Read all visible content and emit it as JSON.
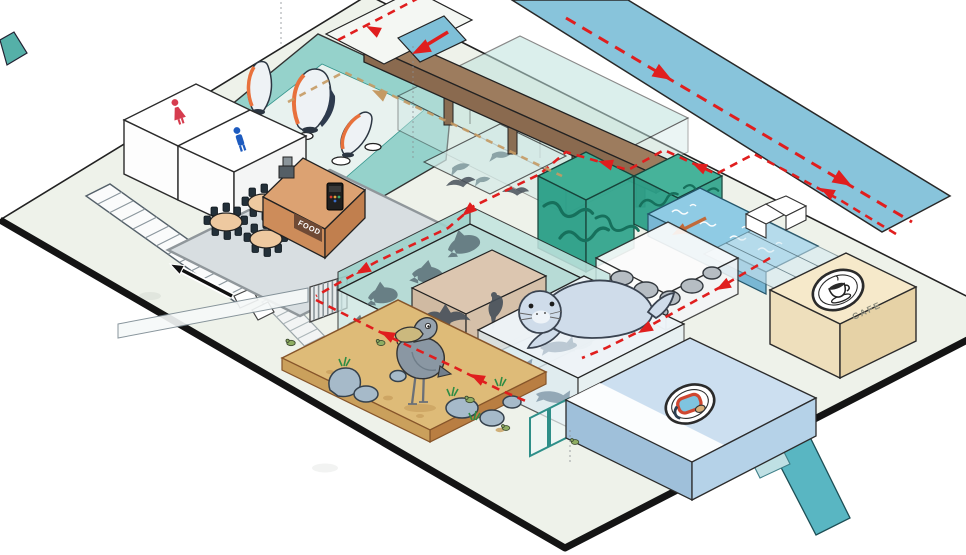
{
  "page": {
    "type": "isometric-aquarium-floor-map-illustration"
  },
  "labels": {
    "food_counter": "FOOD",
    "cafe": "CAFE"
  },
  "icons": {
    "restroom_female": "woman-icon",
    "restroom_male": "man-icon",
    "cafe_badge": "coffee-cup-icon",
    "diving_badge": "snorkel-mask-icon",
    "visitor_route": "red-dashed-arrow",
    "upper_level_route": "tan-dashed-arrow",
    "exit_direction": "black-arrow",
    "water_flow": "orange-arrow"
  },
  "colors": {
    "floor": "#eef2ea",
    "plate_edge": "#141414",
    "route_red": "#e01e1e",
    "route_tan": "#c59a63",
    "tank_glass_teal": "#8fd0ca",
    "tank_deep_green": "#2fa68e",
    "water_channel": "#8fcbe4",
    "bridge_wood": "#9a7a5c",
    "food_counter": "#d99d6d",
    "cafe_box": "#f5e8c9",
    "sand": "#debb78",
    "diving_pool": "#ccdff0",
    "ramp_blue": "#85c3da",
    "seal_body": "#cfdcea",
    "restroom_female": "#d63c4e",
    "restroom_male": "#1d5bbf"
  }
}
